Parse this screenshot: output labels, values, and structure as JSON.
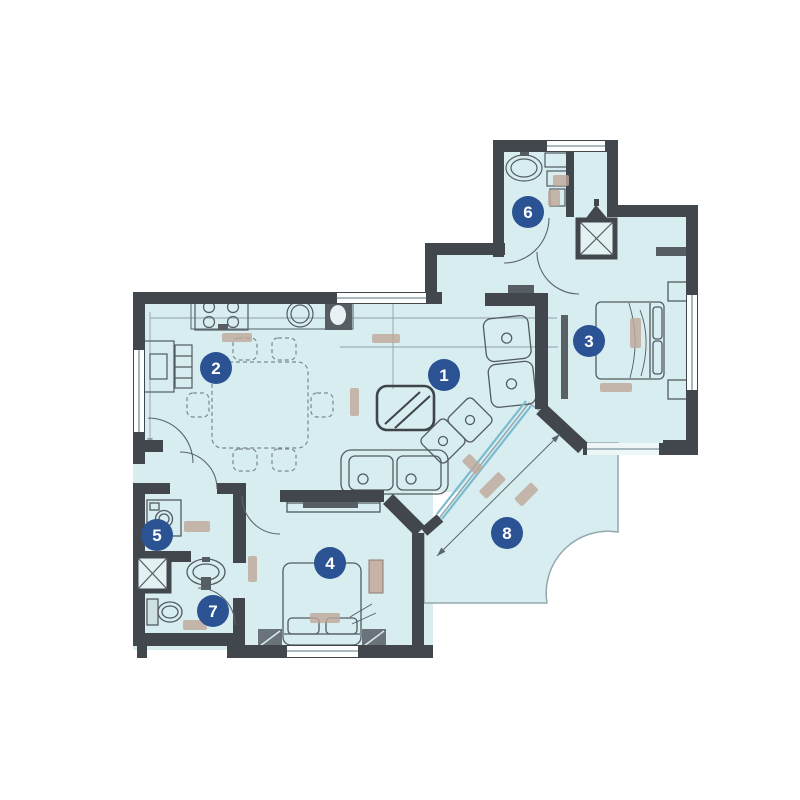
{
  "app": {
    "type": "apartment-floor-plan",
    "background": "#ffffff"
  },
  "plan": {
    "palette": {
      "floor": "#d8edf0",
      "walls": "#42474d",
      "marker_bg": "#2b5293",
      "marker_text": "#ffffff",
      "glass_door": "#7abccf",
      "furniture_line": "#525b61",
      "dimension_mark": "#c0a89b"
    },
    "markers": [
      {
        "number": "1"
      },
      {
        "number": "2"
      },
      {
        "number": "3"
      },
      {
        "number": "4"
      },
      {
        "number": "5"
      },
      {
        "number": "6"
      },
      {
        "number": "7"
      },
      {
        "number": "8"
      }
    ],
    "fixtures": [
      "stove-icon",
      "kitchen-sink-icon",
      "refrigerator-icon",
      "dining-table-icon",
      "chair-icon",
      "sofa-icon",
      "coffee-table-icon",
      "armchair-icon",
      "double-bed-icon",
      "nightstand-icon",
      "wardrobe-icon",
      "washing-machine-icon",
      "bathroom-sink-icon",
      "toilet-icon",
      "shaft-x-icon",
      "sliding-glass-door-icon",
      "door-arc-icon",
      "window-icon",
      "dimension-arrow-icon"
    ],
    "notes": {
      "dimension_labels": "illegible"
    }
  }
}
